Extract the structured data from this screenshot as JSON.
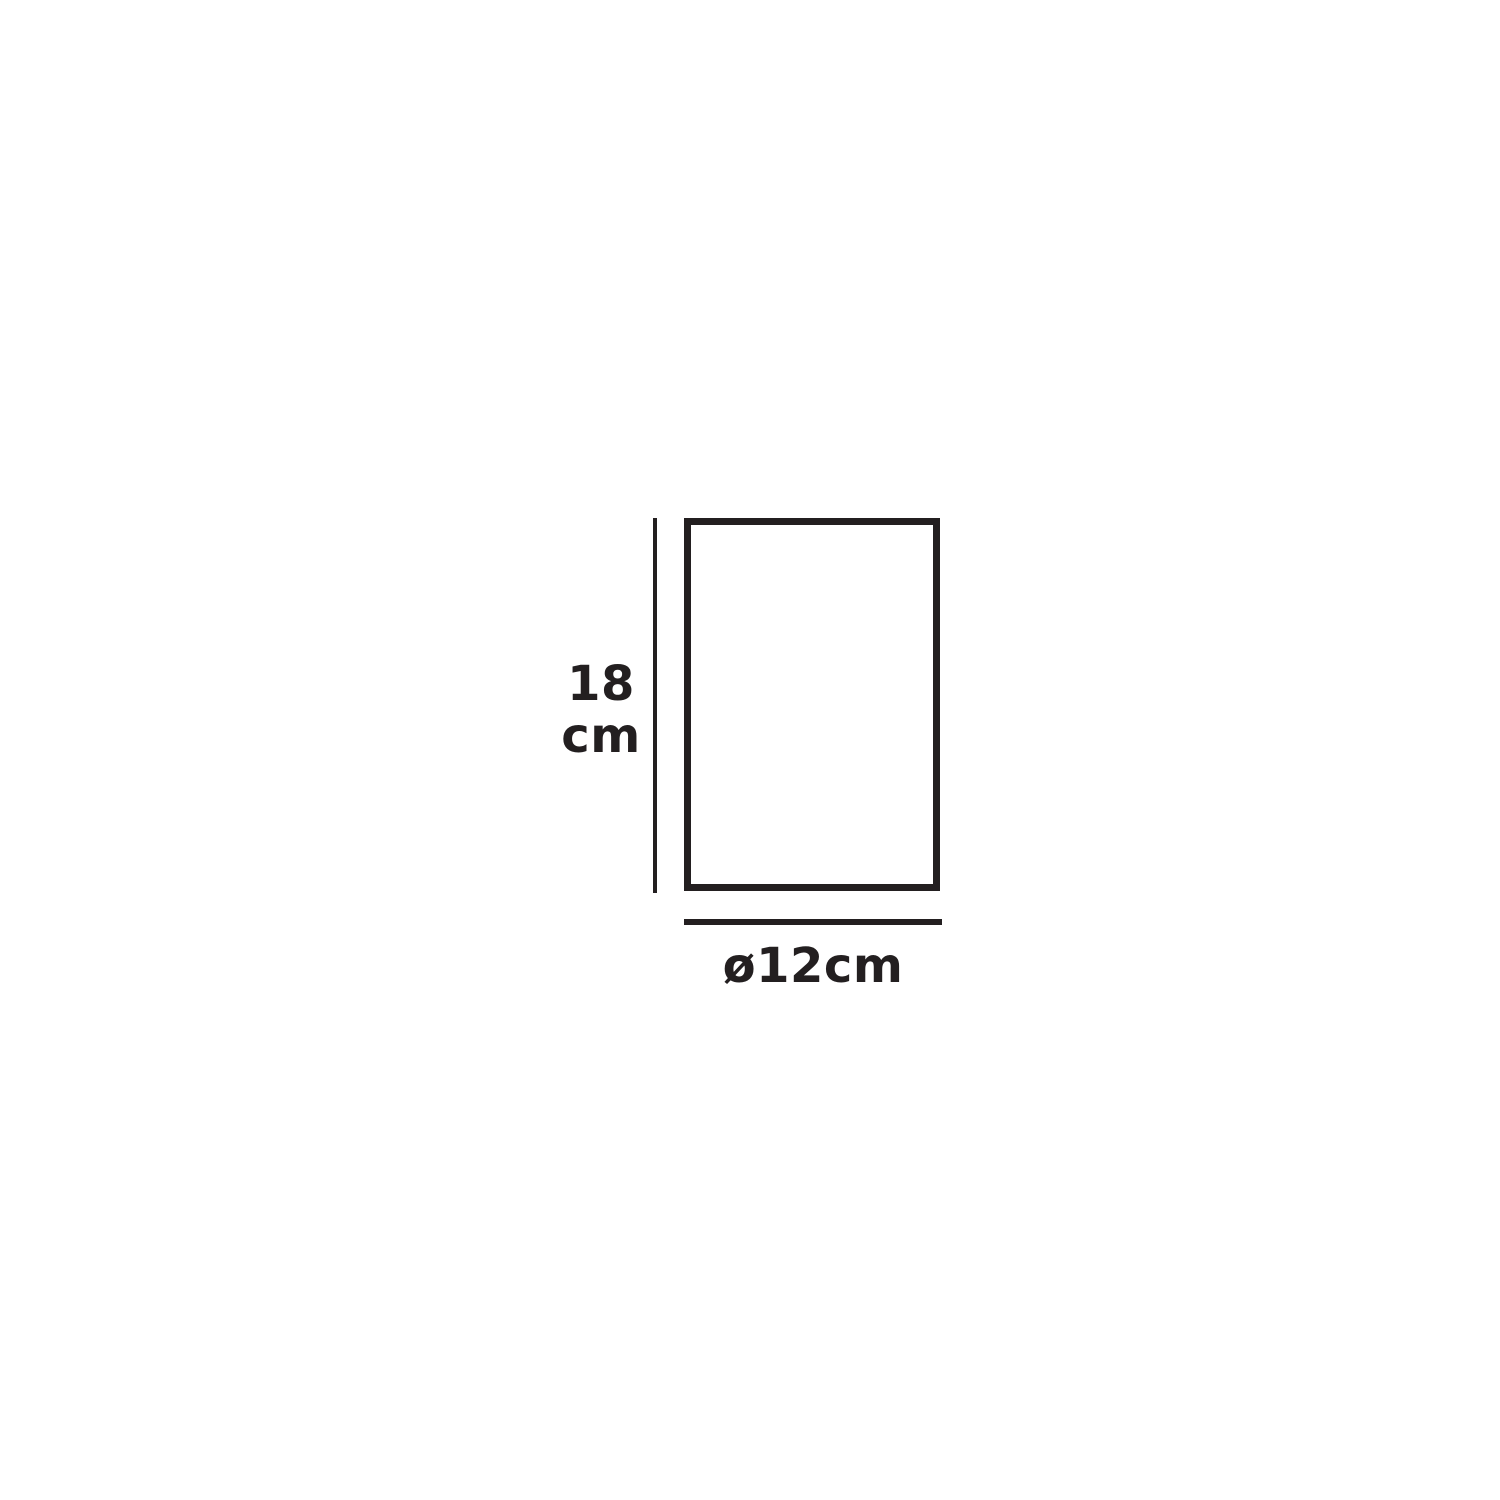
{
  "diagram": {
    "type": "dimension-drawing",
    "shape": "rectangle-outline",
    "height": {
      "label": "18\ncm",
      "value_cm": 18
    },
    "diameter": {
      "label": "ø12cm",
      "value_cm": 12
    },
    "colors": {
      "line": "#231f20",
      "background": "#ffffff"
    }
  }
}
